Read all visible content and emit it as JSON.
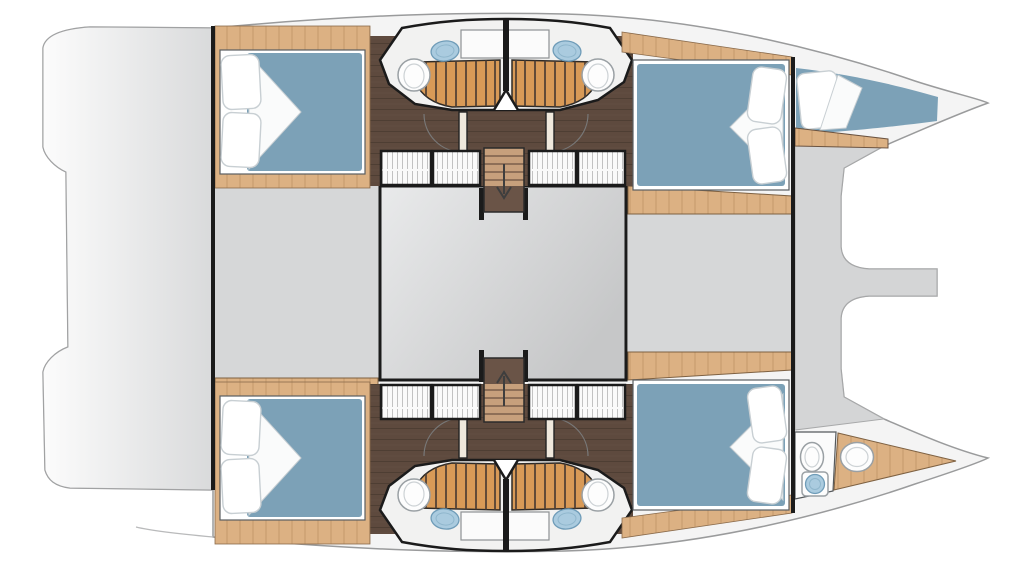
{
  "meta": {
    "title": "Catamaran accommodation deck floor plan",
    "type": "floor-plan",
    "orientation": {
      "bow": "right",
      "stern": "left"
    }
  },
  "inventory": {
    "double_cabins": 4,
    "double_beds": 4,
    "bathrooms": 4,
    "shower_grates": 4,
    "toilets": 5,
    "sinks": 5,
    "wardrobes": 8,
    "staircases": 2,
    "forepeak_berths": 1,
    "forepeak_heads": 1
  },
  "vessel": {
    "type": "catamaran",
    "hulls": [
      {
        "name": "upper hull",
        "rooms": [
          {
            "name": "aft double cabin",
            "fixtures": [
              "double-bed",
              "two-pillows",
              "oak-floor"
            ]
          },
          {
            "name": "en-suite bathroom",
            "fixtures": [
              "washbasin",
              "toilet",
              "teak-shower-grate"
            ]
          },
          {
            "name": "companionway",
            "fixtures": [
              "staircase-down",
              "wardrobes",
              "cabin-doors"
            ]
          },
          {
            "name": "forward double cabin",
            "fixtures": [
              "double-bed",
              "two-pillows"
            ]
          },
          {
            "name": "forepeak berth",
            "fixtures": [
              "single-berth",
              "pillow"
            ]
          }
        ]
      },
      {
        "name": "lower hull",
        "rooms": [
          {
            "name": "aft double cabin",
            "fixtures": [
              "double-bed",
              "two-pillows",
              "oak-floor"
            ]
          },
          {
            "name": "en-suite bathroom",
            "fixtures": [
              "washbasin",
              "toilet",
              "teak-shower-grate"
            ]
          },
          {
            "name": "companionway",
            "fixtures": [
              "staircase-down",
              "wardrobes",
              "cabin-doors"
            ]
          },
          {
            "name": "forward double cabin",
            "fixtures": [
              "double-bed",
              "two-pillows"
            ]
          },
          {
            "name": "forepeak head",
            "fixtures": [
              "toilet",
              "washbasin",
              "sink",
              "teak-floor"
            ]
          }
        ]
      }
    ],
    "bridgedeck": {
      "rooms": [
        "aft deck",
        "saloon footprint",
        "forward deck",
        "forward beam and steps"
      ]
    }
  },
  "colors": {
    "page_bg": "#ffffff",
    "hull_fill": "#f4f4f4",
    "hull_outline": "#9a9b9c",
    "platform_light": "#fcfcfc",
    "platform_dark": "#d9dadb",
    "deck_gray": "#d6d7d8",
    "deck_edge": "#b9babb",
    "saloon_light": "#e9eaeb",
    "saloon_dark": "#c6c7c8",
    "wall": "#1b1b1b",
    "wood": "#dcb183",
    "wood_grain": "#b98e5f",
    "wood_edge": "#7e6142",
    "teak": "#d89a57",
    "teak_slat": "#4e3e33",
    "walnut": "#5e4a3e",
    "walnut_plank": "#4a3a30",
    "mattress": "#7ca1b7",
    "pillow": "#ffffff",
    "pillow_edge": "#c8cfd3",
    "duvet": "#fafbfb",
    "sink": "#aacbdf",
    "sink_dark": "#6f9cb8",
    "fixture": "#fdfdfd",
    "fixture_edge": "#9aa0a4",
    "hatch_line": "#c2c2c2",
    "door_leaf": "#efe8dc",
    "arc": "#787878",
    "arrow": "#3e3e3e",
    "frame_white": "#ffffff",
    "frame_edge": "#5a5e61"
  }
}
